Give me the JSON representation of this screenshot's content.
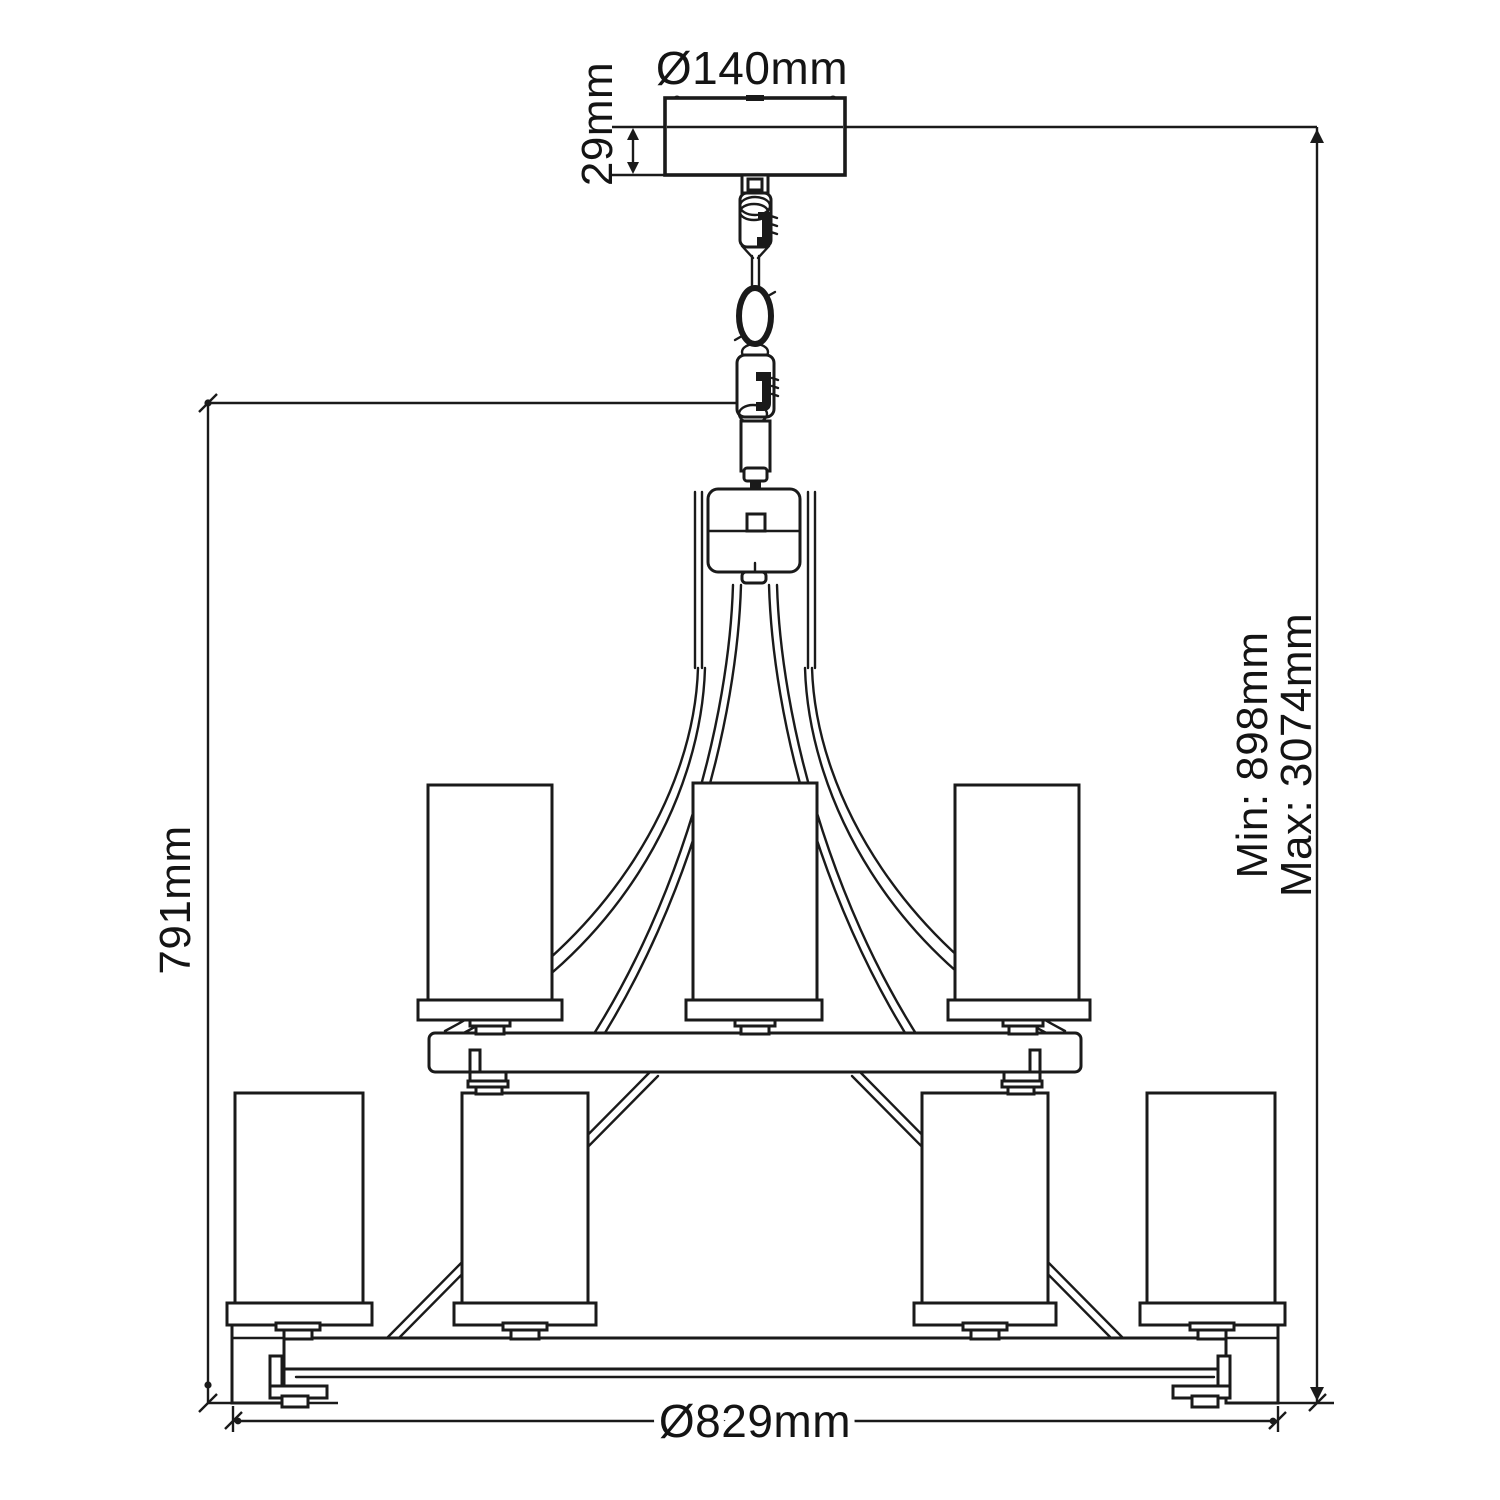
{
  "drawing": {
    "kind": "chandelier-dimension-diagram",
    "dimensions": {
      "canopy_diameter": "Ø140mm",
      "canopy_height": "29mm",
      "body_height": "791mm",
      "min_drop": "Min: 898mm",
      "max_drop": "Max: 3074mm",
      "fixture_diameter": "Ø829mm"
    },
    "colors": {
      "line": "#1a1a1a",
      "background": "#ffffff"
    }
  }
}
